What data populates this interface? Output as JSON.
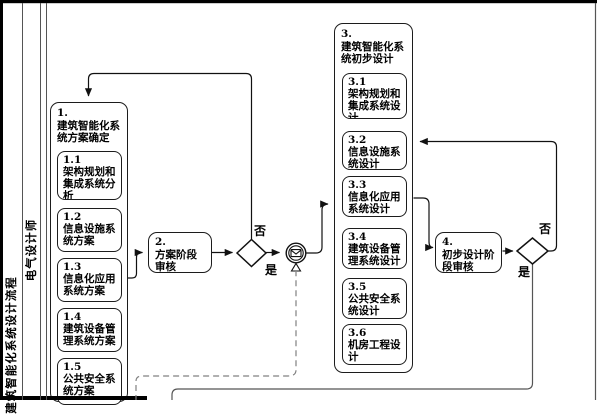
{
  "pool": {
    "label": "建筑智能化系统设计流程"
  },
  "lane": {
    "label": "电气设计师"
  },
  "process1": {
    "title": "1.\n建筑智能化系\n统方案确定",
    "steps": [
      {
        "text": "1.1\n架构规划和\n集成系统分\n析"
      },
      {
        "text": "1.2\n信息设施系\n统方案"
      },
      {
        "text": "1.3\n信息化应用\n系统方案"
      },
      {
        "text": "1.4\n建筑设备管\n理系统方案"
      },
      {
        "text": "1.5\n公共安全系\n统方案"
      }
    ]
  },
  "review1": {
    "text": "2.\n方案阶段\n审核"
  },
  "gateway1": {
    "no": "否",
    "yes": "是"
  },
  "process3": {
    "title": "3.\n建筑智能化系\n统初步设计",
    "steps": [
      {
        "text": "3.1\n架构规划和\n集成系统设\n计"
      },
      {
        "text": "3.2\n信息设施系\n统设计"
      },
      {
        "text": "3.3\n信息化应用\n系统设计"
      },
      {
        "text": "3.4\n建筑设备管\n理系统设计"
      },
      {
        "text": "3.5\n公共安全系\n统设计"
      },
      {
        "text": "3.6\n机房工程设\n计"
      }
    ]
  },
  "review2": {
    "text": "4.\n初步设计阶\n段审核"
  },
  "gateway2": {
    "no": "否",
    "yes": "是"
  },
  "colors": {
    "line": "#111111",
    "message_flow": "#808080",
    "border": "#1c1c1c"
  }
}
